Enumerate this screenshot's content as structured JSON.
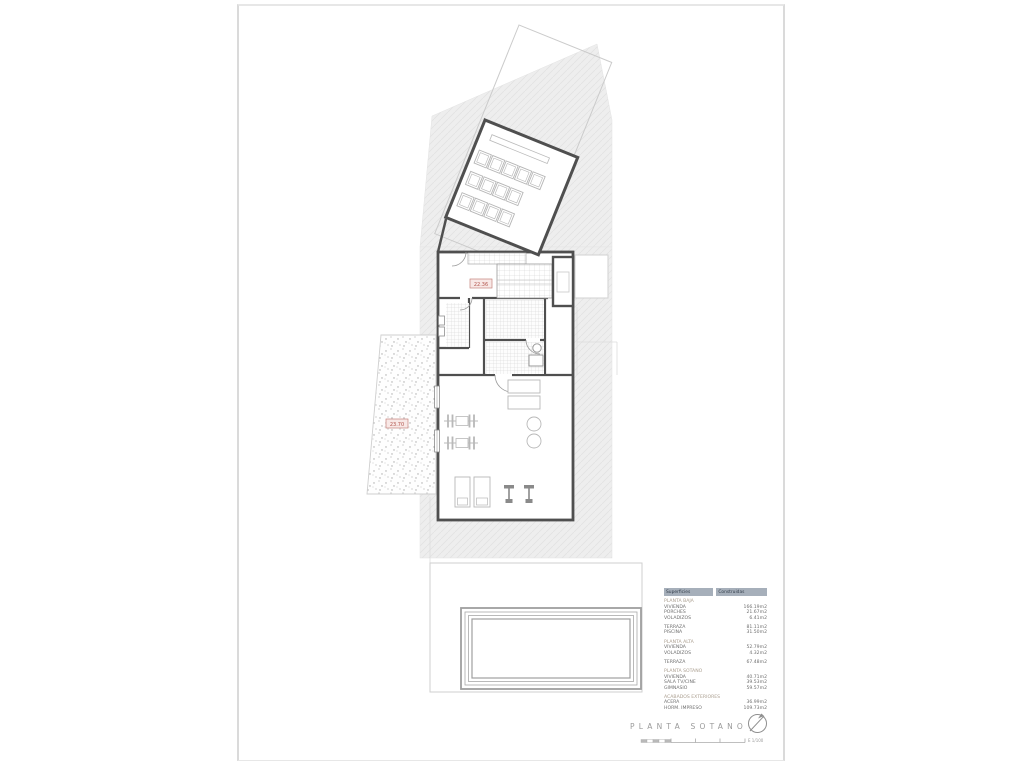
{
  "drawing": {
    "title": "PLANTA SOTANO",
    "scale_label": "E 1/100",
    "levels": {
      "stair_level": "22.36",
      "patio_level": "23.70"
    }
  },
  "areas_table": {
    "header": {
      "left": "Superficies",
      "right": "Construidas"
    },
    "rows": [
      {
        "label": "PLANTA BAJA",
        "value": ""
      },
      {
        "label": "VIVIENDA",
        "value": "166.19m2"
      },
      {
        "label": "PORCHES",
        "value": "21.67m2"
      },
      {
        "label": "VOLADIZOS",
        "value": "6.41m2"
      },
      {
        "label": "TERRAZA",
        "value": "81.11m2"
      },
      {
        "label": "PISCINA",
        "value": "31.50m2"
      },
      {
        "label": "PLANTA ALTA",
        "value": ""
      },
      {
        "label": "VIVIENDA",
        "value": "52.79m2"
      },
      {
        "label": "VOLADIZOS",
        "value": "4.32m2"
      },
      {
        "label": "TERRAZA",
        "value": "67.48m2"
      },
      {
        "label": "PLANTA SOTANO",
        "value": ""
      },
      {
        "label": "VIVIENDA",
        "value": "40.71m2"
      },
      {
        "label": "SALA TV/CINE",
        "value": "39.53m2"
      },
      {
        "label": "GIMNASIO",
        "value": "59.57m2"
      },
      {
        "label": "ACABADOS EXTERIORES",
        "value": ""
      },
      {
        "label": "ACERA",
        "value": "36.99m2"
      },
      {
        "label": "HORM. IMPRESO",
        "value": "109.73m2"
      }
    ]
  },
  "colors": {
    "wall": "#4f4f4f",
    "light_line": "#cbcbcb",
    "hatch_fill": "#eeeeee",
    "accent_red": "#b2544c",
    "table_header_bg": "#a6afba"
  }
}
